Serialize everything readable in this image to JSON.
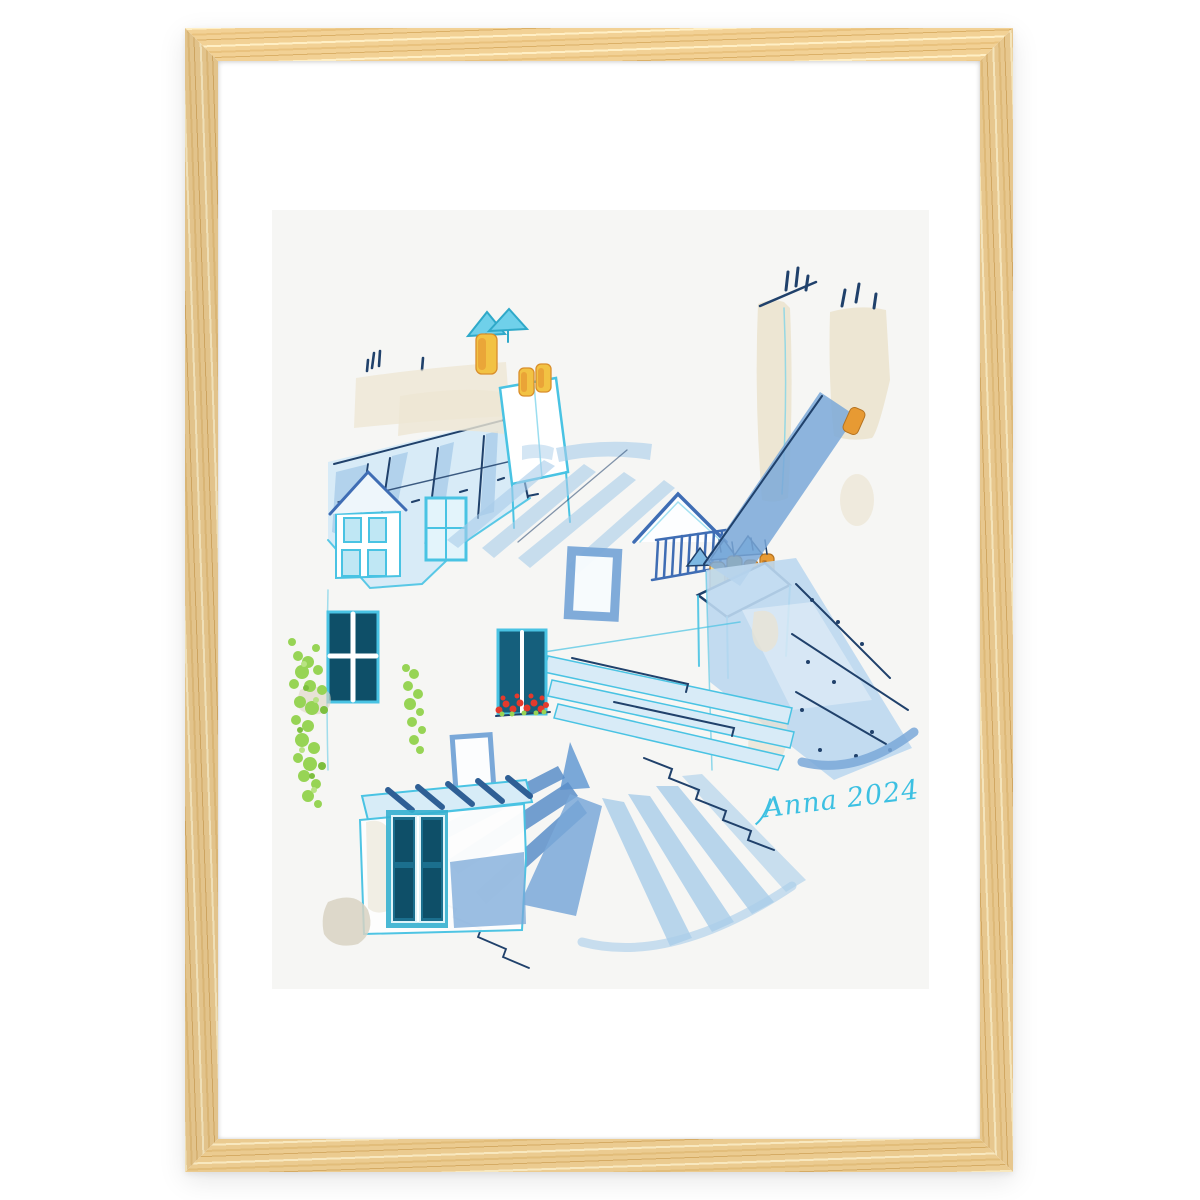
{
  "scene": {
    "type": "photo of a framed watercolor art print",
    "background_color": "#ffffff",
    "frame": {
      "material": "light oak wood",
      "wood": "#e9c98f",
      "wood_dark": "#d3a963",
      "wood_mid": "#e0bb79",
      "wood_light": "#f6e6bd",
      "mat_color": "#ffffff"
    },
    "print": {
      "paper_color": "#f6f6f4",
      "signature": "Anna 2024",
      "subject_elements": [
        "paris zinc mansard rooftops",
        "dormer windows",
        "chimney stacks with terracotta pots",
        "rooftop ridge railing",
        "skylights",
        "window with red geraniums",
        "climbing green vine",
        "teal french doors",
        "tv antennas"
      ],
      "palette": {
        "cyan": "#49c3e3",
        "paleblue": "#d8ebf7",
        "softblue": "#a9cdea",
        "midblue": "#7aa8d8",
        "deepblue": "#3f6db4",
        "navy": "#20416b",
        "cream": "#ede6d3",
        "beige": "#ddd6c2",
        "yellow": "#f2c243",
        "orange": "#e79a33",
        "red": "#e43a2c",
        "green": "#97d455",
        "greendark": "#7dbf3f",
        "greenlight": "#b8e383",
        "teal": "#1b6f8e",
        "tealdark": "#0e4f68",
        "doorteal": "#35b0cf",
        "sig": "#3cc0e2"
      }
    }
  }
}
